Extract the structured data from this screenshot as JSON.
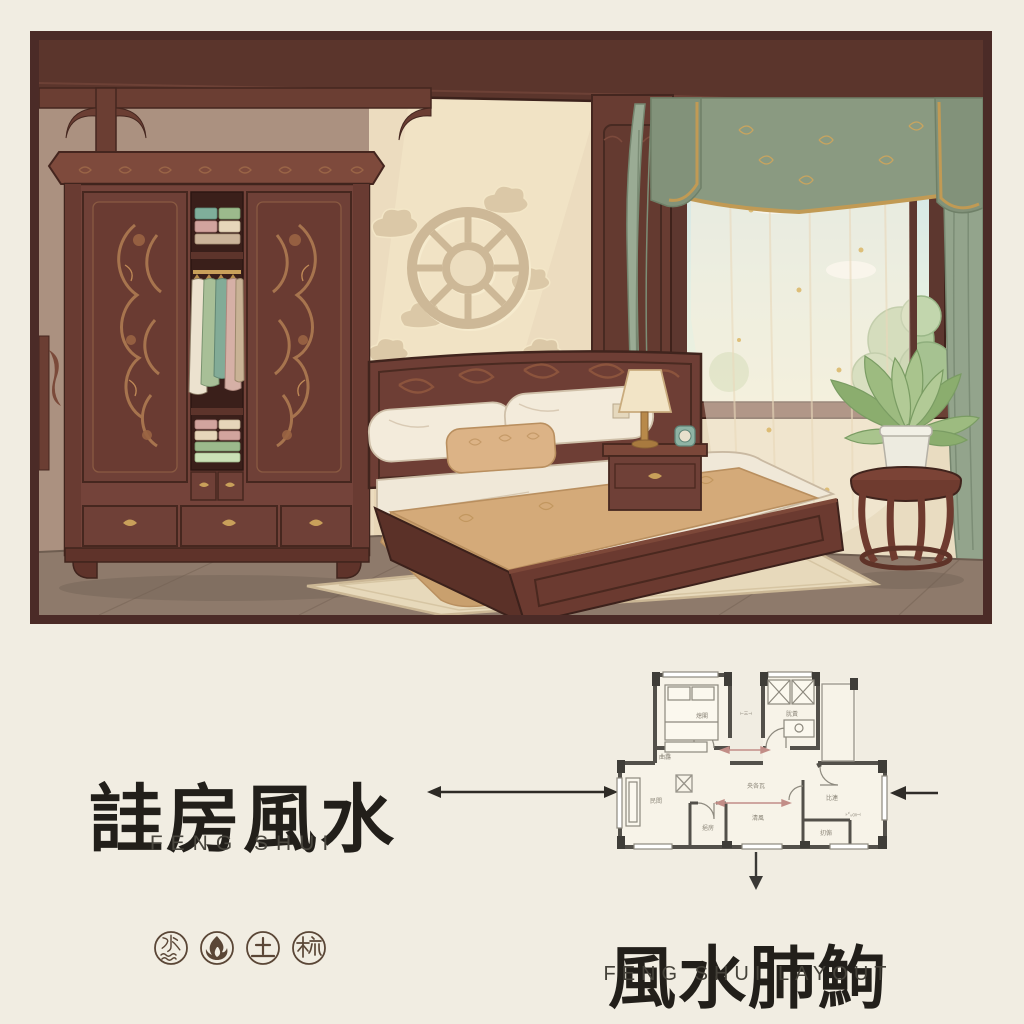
{
  "page": {
    "background": "#f1ede2"
  },
  "illustration": {
    "alt": "Chinese-style bedroom with carved dragon wardrobe, bed, bagua wall medallion, window with green curtains and potted plant",
    "frame_color": "#4b2b27",
    "palette": {
      "wood_dark": "#5b352c",
      "wood": "#74433a",
      "wood_carving": "#a7744e",
      "wall_warm": "#ecdcbf",
      "wall_shaded": "#ab9180",
      "light_beam": "#f6e9cb",
      "curtain_green": "#9aab94",
      "valance_green": "#8a9a81",
      "gold_trim": "#c9a25c",
      "sky": "#cde3e8",
      "foliage": "#9dbb80",
      "bed_sheet": "#f0e8d8",
      "blanket": "#d4aa79",
      "floor": "#8e7a6b",
      "rug": "#e7d9bb"
    }
  },
  "left_block": {
    "title_cn": "詿房風水",
    "subtitle_en": "FENG SHUI",
    "ink_color": "#221f1a",
    "element_icons": [
      {
        "name": "water-element-icon",
        "glyph": "水"
      },
      {
        "name": "fire-element-icon",
        "glyph": "flame"
      },
      {
        "name": "earth-element-icon",
        "glyph": "土"
      },
      {
        "name": "wood-element-icon",
        "glyph": "梳"
      }
    ],
    "icon_color": "#5a4636"
  },
  "right_block": {
    "title_cn": "風水肺鮈",
    "subtitle_en": "FENG SHUI LAYOUT"
  },
  "floorplan": {
    "wall_color": "#53504a",
    "line_color": "#98948a",
    "red_arrow_color": "#c28d87",
    "black_arrow_color": "#2e2b26",
    "labels": [
      {
        "id": "bedroom-left",
        "text": "熄閣"
      },
      {
        "id": "bedroom-left-sub",
        "text": "曲馫"
      },
      {
        "id": "bedroom-right",
        "text": "肬黃"
      },
      {
        "id": "hall-upper",
        "text": "央各瓦"
      },
      {
        "id": "hall-lower",
        "text": "清風"
      },
      {
        "id": "living",
        "text": "民閻"
      },
      {
        "id": "dining",
        "text": "比連"
      },
      {
        "id": "dining-dim",
        "text": "⊦㌱㎝⊣"
      },
      {
        "id": "bath",
        "text": "挹房"
      },
      {
        "id": "kitchen",
        "text": "㧅傓"
      },
      {
        "id": "corridor-dim",
        "text": "⊢㆔⊣"
      }
    ]
  }
}
